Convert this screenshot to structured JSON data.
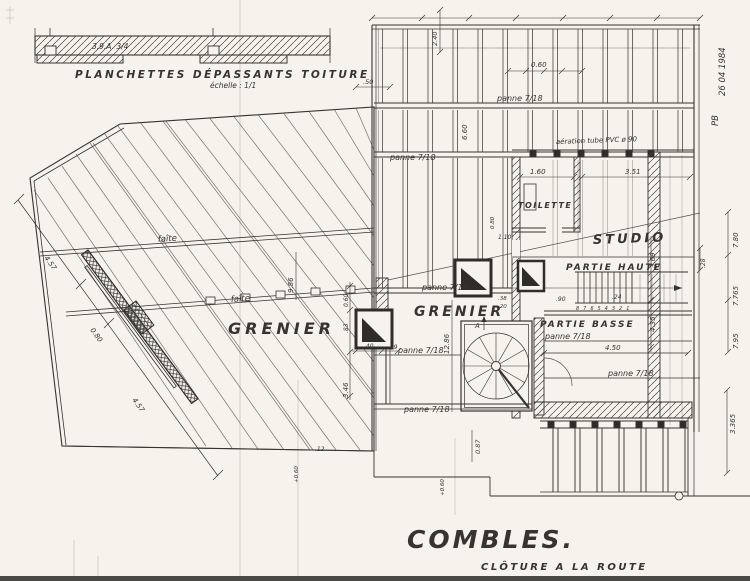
{
  "paper": "#f5f3ec",
  "ink": "#35342e",
  "drawing": {
    "title": "COMBLES.",
    "subtitle": "CLÔTURE A LA ROUTE",
    "detail": {
      "caption": "PLANCHETTES DÉPASSANTS TOITURE",
      "scale": "échelle : 1/1",
      "note": "3.9.A. 3/4"
    },
    "rooms": {
      "grenier": "GRENIER",
      "toilette": "TOILETTE",
      "studio": "STUDIO",
      "partie_haute": "PARTIE HAUTE",
      "partie_basse": "PARTIE BASSE"
    },
    "annotations": {
      "panne": "panne 7/18",
      "faite": "faîte",
      "aeration": "aération tube PVC ø 90",
      "stair_numbers": "8 7 6 5 4 3 2 1",
      "point_a": "A",
      "date_note": "26 04 1984",
      "initials": "PB"
    },
    "dims": {
      "v060": "0.60",
      "v660": "6.60",
      "v050": ".50",
      "v240": "2.40",
      "v160": "1.60",
      "v351": "3.51",
      "v780": "7.80",
      "v7765": "7.765",
      "v795": "7.95",
      "v028": ".28",
      "v3365": "3.365",
      "v450": "4.50",
      "v435": "4.35",
      "v369": "3.69",
      "v090": ".90",
      "v024": ".24",
      "v038": ".38",
      "v020": ".20",
      "v1286": "12.86",
      "v346": "3.46",
      "v083": ".83",
      "v040": ".40",
      "v019": ".19",
      "v080": "0.80",
      "v457": "4.57",
      "v986": "9.86",
      "v087": "0.87",
      "v012": ".12",
      "vp060": "+0.60",
      "v110": "1.10"
    }
  }
}
